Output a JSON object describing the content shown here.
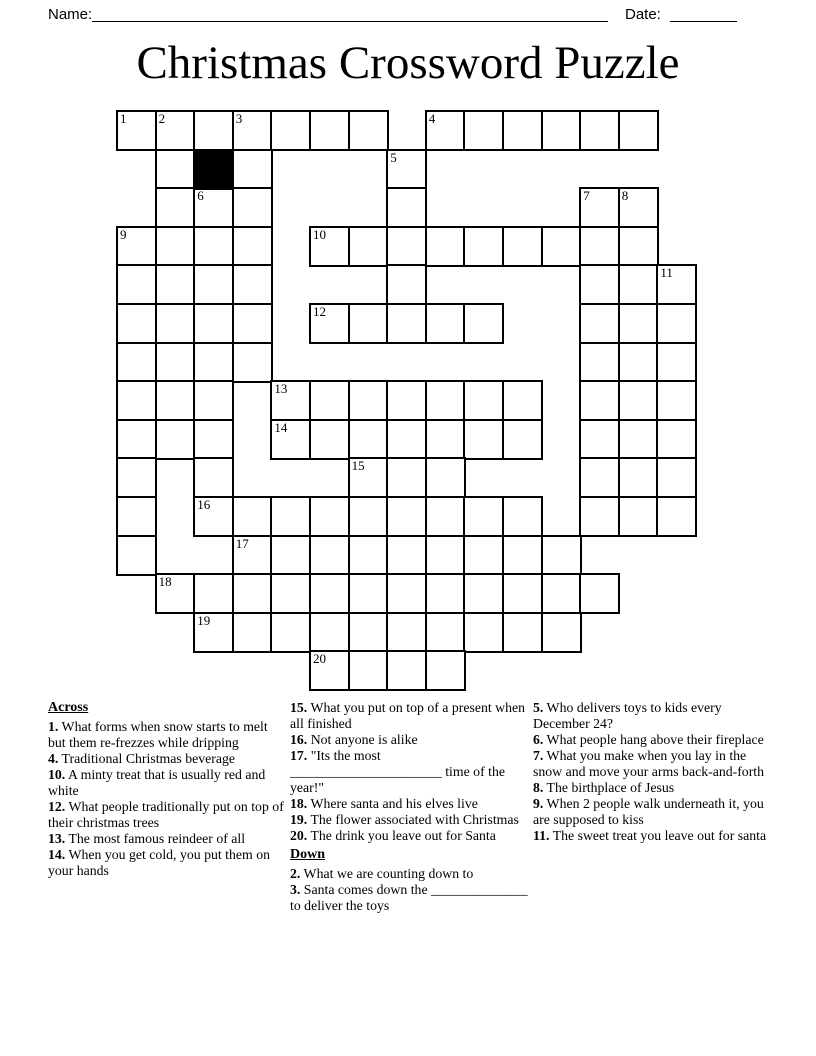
{
  "header": {
    "name_label": "Name:",
    "date_label": "Date:"
  },
  "title": "Christmas Crossword Puzzle",
  "grid": {
    "rows": 15,
    "cols": 15,
    "left_px": 116,
    "top_px": 110,
    "cell_px": 38.6,
    "border_px": 2.5,
    "white_cells": [
      [
        0,
        0,
        "1"
      ],
      [
        0,
        1,
        "2"
      ],
      [
        0,
        2
      ],
      [
        0,
        3,
        "3"
      ],
      [
        0,
        4
      ],
      [
        0,
        5
      ],
      [
        0,
        6
      ],
      [
        0,
        8,
        "4"
      ],
      [
        0,
        9
      ],
      [
        0,
        10
      ],
      [
        0,
        11
      ],
      [
        0,
        12
      ],
      [
        0,
        13
      ],
      [
        1,
        1
      ],
      [
        1,
        3
      ],
      [
        1,
        7,
        "5"
      ],
      [
        2,
        1
      ],
      [
        2,
        2,
        "6"
      ],
      [
        2,
        3
      ],
      [
        2,
        7
      ],
      [
        2,
        12,
        "7"
      ],
      [
        2,
        13,
        "8"
      ],
      [
        3,
        0,
        "9"
      ],
      [
        3,
        1
      ],
      [
        3,
        2
      ],
      [
        3,
        3
      ],
      [
        3,
        5,
        "10"
      ],
      [
        3,
        6
      ],
      [
        3,
        7
      ],
      [
        3,
        8
      ],
      [
        3,
        9
      ],
      [
        3,
        10
      ],
      [
        3,
        11
      ],
      [
        3,
        12
      ],
      [
        3,
        13
      ],
      [
        4,
        0
      ],
      [
        4,
        1
      ],
      [
        4,
        2
      ],
      [
        4,
        3
      ],
      [
        4,
        7
      ],
      [
        4,
        12
      ],
      [
        4,
        13
      ],
      [
        4,
        14,
        "11"
      ],
      [
        5,
        0
      ],
      [
        5,
        1
      ],
      [
        5,
        2
      ],
      [
        5,
        3
      ],
      [
        5,
        5,
        "12"
      ],
      [
        5,
        6
      ],
      [
        5,
        7
      ],
      [
        5,
        8
      ],
      [
        5,
        9
      ],
      [
        5,
        12
      ],
      [
        5,
        13
      ],
      [
        5,
        14
      ],
      [
        6,
        0
      ],
      [
        6,
        1
      ],
      [
        6,
        2
      ],
      [
        6,
        3
      ],
      [
        6,
        12
      ],
      [
        6,
        13
      ],
      [
        6,
        14
      ],
      [
        7,
        0
      ],
      [
        7,
        1
      ],
      [
        7,
        2
      ],
      [
        7,
        4,
        "13"
      ],
      [
        7,
        5
      ],
      [
        7,
        6
      ],
      [
        7,
        7
      ],
      [
        7,
        8
      ],
      [
        7,
        9
      ],
      [
        7,
        10
      ],
      [
        7,
        12
      ],
      [
        7,
        13
      ],
      [
        7,
        14
      ],
      [
        8,
        0
      ],
      [
        8,
        1
      ],
      [
        8,
        2
      ],
      [
        8,
        4,
        "14"
      ],
      [
        8,
        5
      ],
      [
        8,
        6
      ],
      [
        8,
        7
      ],
      [
        8,
        8
      ],
      [
        8,
        9
      ],
      [
        8,
        10
      ],
      [
        8,
        12
      ],
      [
        8,
        13
      ],
      [
        8,
        14
      ],
      [
        9,
        0
      ],
      [
        9,
        2
      ],
      [
        9,
        6,
        "15"
      ],
      [
        9,
        7
      ],
      [
        9,
        8
      ],
      [
        9,
        12
      ],
      [
        9,
        13
      ],
      [
        9,
        14
      ],
      [
        10,
        0
      ],
      [
        10,
        2,
        "16"
      ],
      [
        10,
        3
      ],
      [
        10,
        4
      ],
      [
        10,
        5
      ],
      [
        10,
        6
      ],
      [
        10,
        7
      ],
      [
        10,
        8
      ],
      [
        10,
        9
      ],
      [
        10,
        10
      ],
      [
        10,
        12
      ],
      [
        10,
        13
      ],
      [
        10,
        14
      ],
      [
        11,
        0
      ],
      [
        11,
        3,
        "17"
      ],
      [
        11,
        4
      ],
      [
        11,
        5
      ],
      [
        11,
        6
      ],
      [
        11,
        7
      ],
      [
        11,
        8
      ],
      [
        11,
        9
      ],
      [
        11,
        10
      ],
      [
        11,
        11
      ],
      [
        12,
        1,
        "18"
      ],
      [
        12,
        2
      ],
      [
        12,
        3
      ],
      [
        12,
        4
      ],
      [
        12,
        5
      ],
      [
        12,
        6
      ],
      [
        12,
        7
      ],
      [
        12,
        8
      ],
      [
        12,
        9
      ],
      [
        12,
        10
      ],
      [
        12,
        11
      ],
      [
        12,
        12
      ],
      [
        13,
        2,
        "19"
      ],
      [
        13,
        3
      ],
      [
        13,
        4
      ],
      [
        13,
        5
      ],
      [
        13,
        6
      ],
      [
        13,
        7
      ],
      [
        13,
        8
      ],
      [
        13,
        9
      ],
      [
        13,
        10
      ],
      [
        13,
        11
      ],
      [
        14,
        5,
        "20"
      ],
      [
        14,
        6
      ],
      [
        14,
        7
      ],
      [
        14,
        8
      ]
    ],
    "black_cells": [
      [
        1,
        2
      ]
    ]
  },
  "clues": {
    "across_heading": "Across",
    "down_heading": "Down",
    "columns": [
      {
        "blocks": [
          {
            "heading": "Across"
          },
          {
            "num": "1",
            "text": "What forms when snow starts to melt but them re-frezzes while dripping"
          },
          {
            "num": "4",
            "text": "Traditional Christmas beverage"
          },
          {
            "num": "10",
            "text": "A minty treat that is usually red and white"
          },
          {
            "num": "12",
            "text": "What people traditionally put on top of their christmas trees"
          },
          {
            "num": "13",
            "text": "The most famous reindeer of all"
          },
          {
            "num": "14",
            "text": "When you get cold, you put them on your hands"
          }
        ]
      },
      {
        "blocks": [
          {
            "num": "15",
            "text": "What you put on top of a present when all finished"
          },
          {
            "num": "16",
            "text": "Not anyone is alike"
          },
          {
            "num": "17",
            "text": "\"Its the most ______________________ time of the year!\""
          },
          {
            "num": "18",
            "text": "Where santa and his elves live"
          },
          {
            "num": "19",
            "text": "The flower associated with Christmas"
          },
          {
            "num": "20",
            "text": "The drink you leave out for Santa"
          },
          {
            "heading": "Down"
          },
          {
            "num": "2",
            "text": "What we are counting down to"
          },
          {
            "num": "3",
            "text": "Santa comes down the ______________ to deliver the toys"
          }
        ]
      },
      {
        "blocks": [
          {
            "num": "5",
            "text": "Who delivers toys to kids every December 24?"
          },
          {
            "num": "6",
            "text": "What people hang above their fireplace"
          },
          {
            "num": "7",
            "text": "What you make when you lay in the snow and move your arms back-and-forth"
          },
          {
            "num": "8",
            "text": "The birthplace of Jesus"
          },
          {
            "num": "9",
            "text": "When 2 people walk underneath it, you are supposed to kiss"
          },
          {
            "num": "11",
            "text": "The sweet treat you leave out for santa"
          }
        ]
      }
    ]
  }
}
